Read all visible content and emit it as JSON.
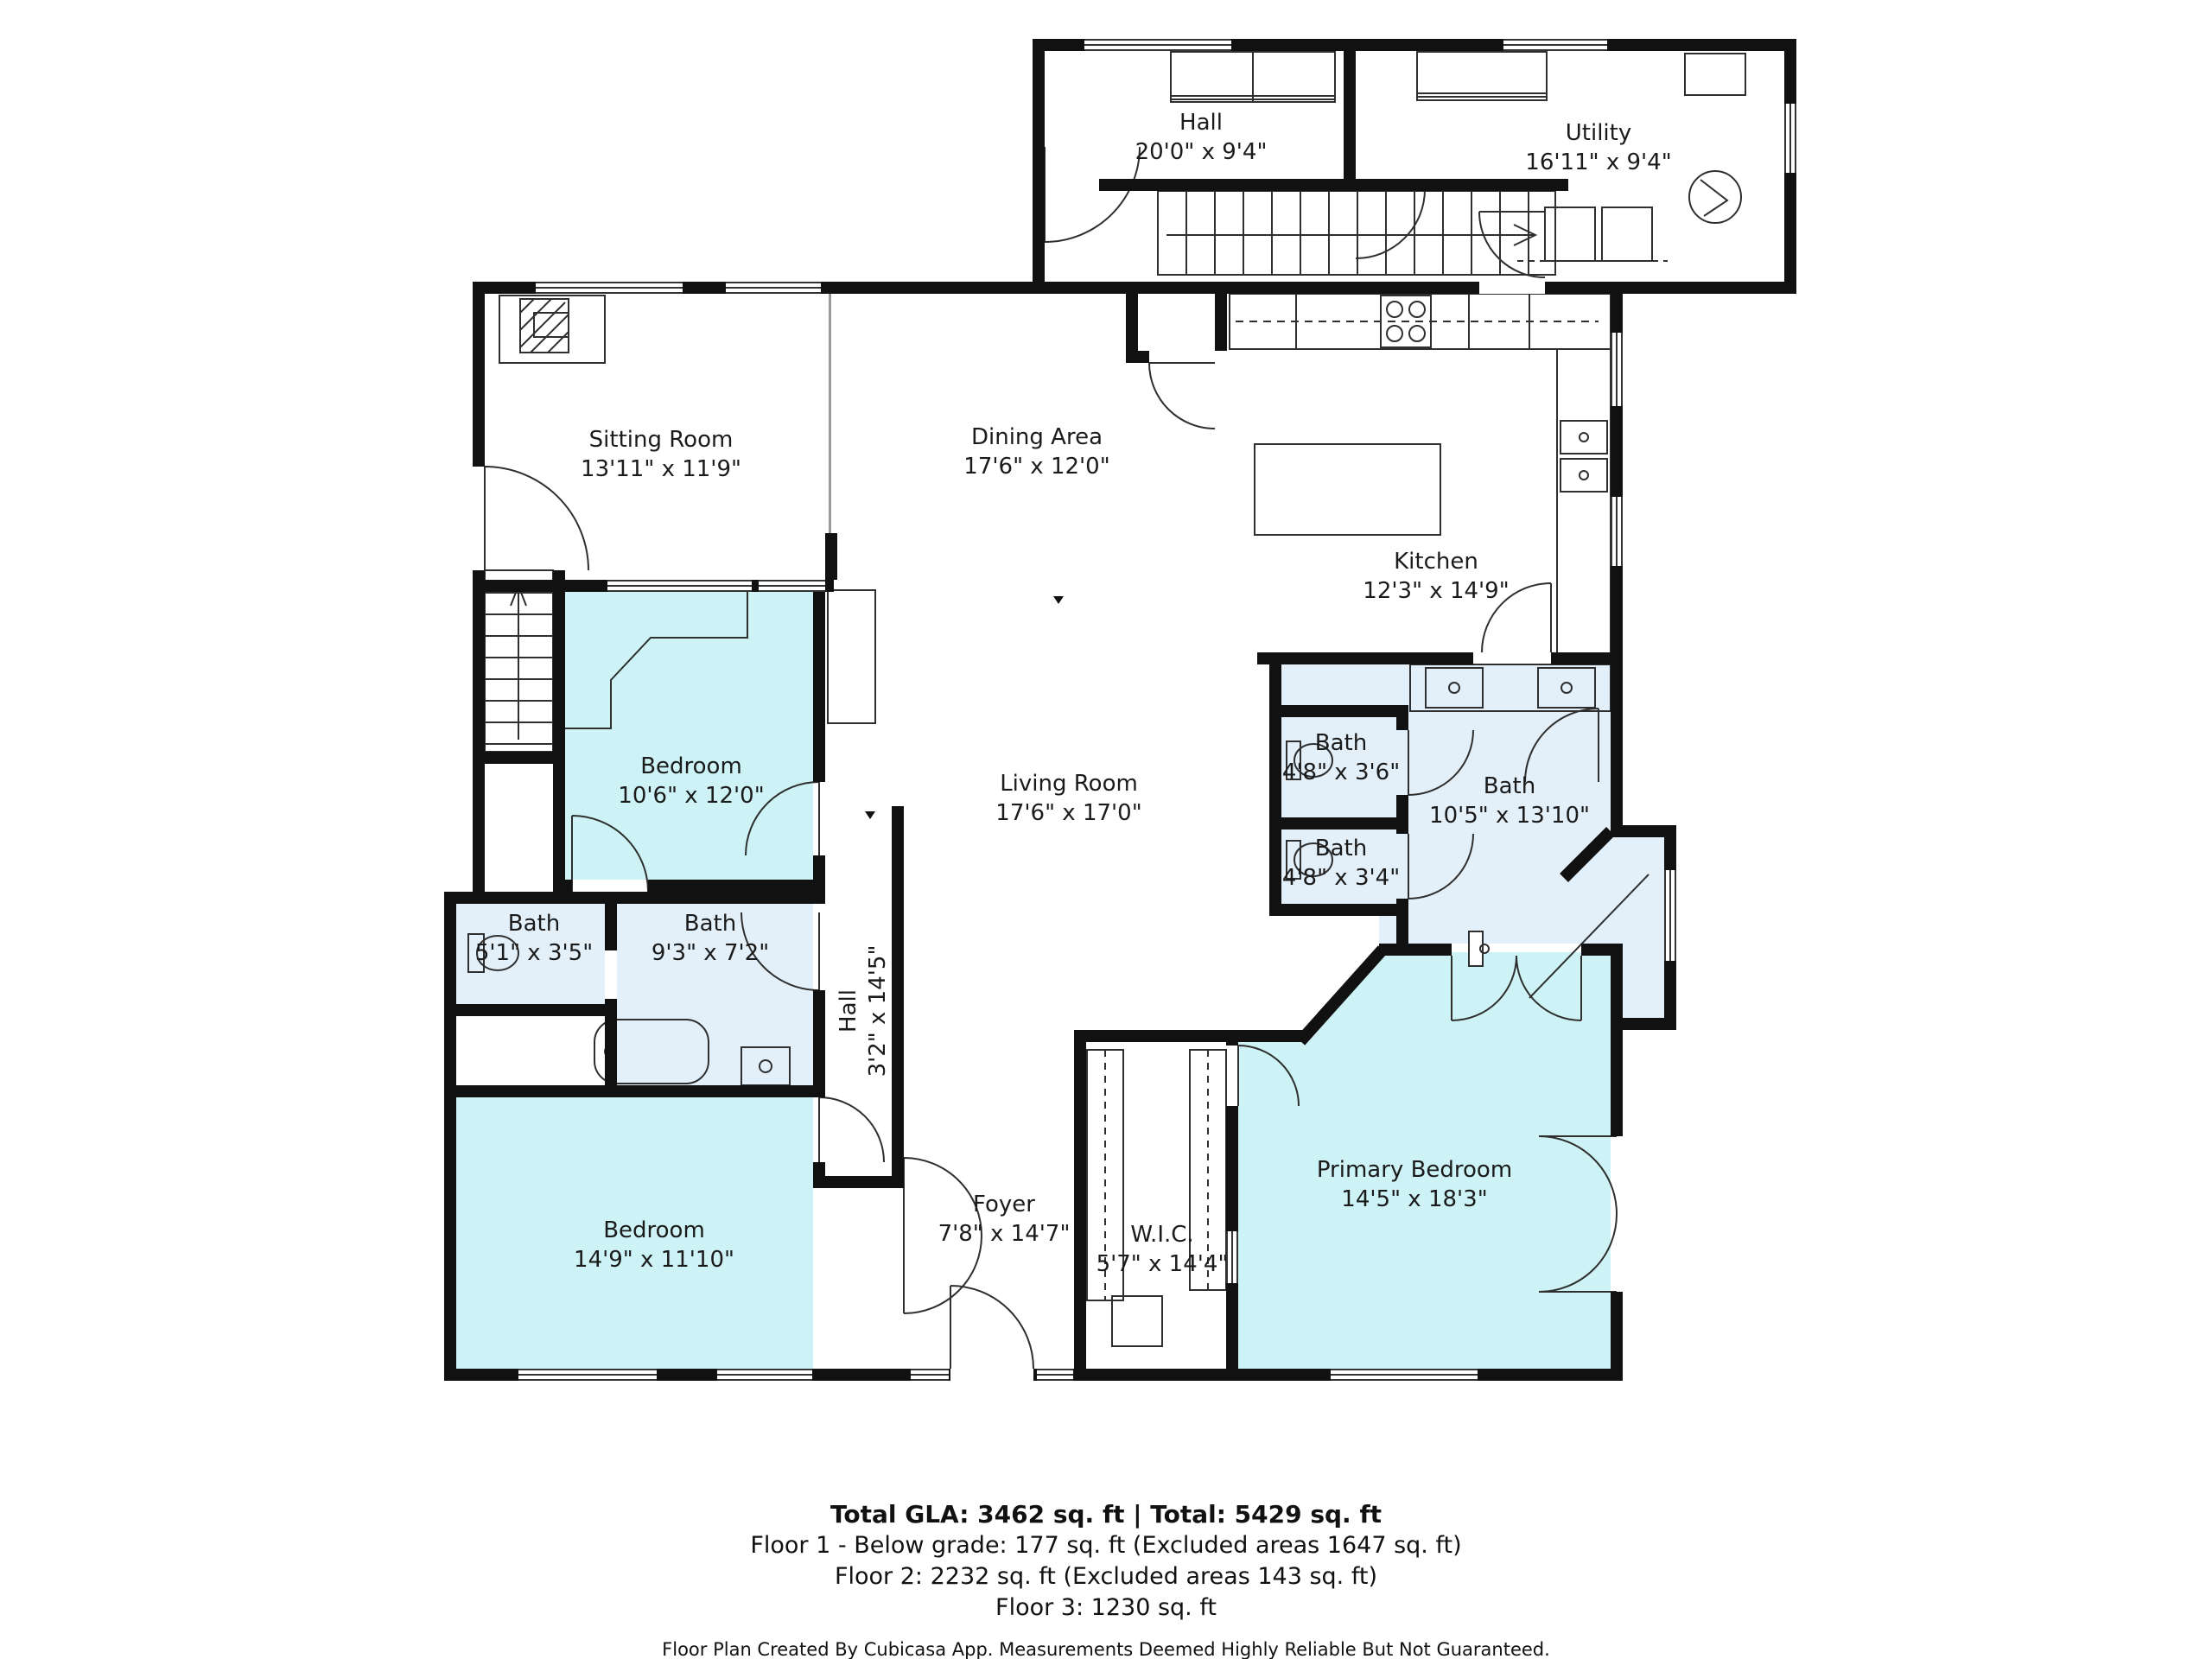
{
  "plan": {
    "rooms": {
      "hall_top": {
        "name": "Hall",
        "dims": "20'0\" x 9'4\""
      },
      "utility": {
        "name": "Utility",
        "dims": "16'11\" x 9'4\""
      },
      "sitting_room": {
        "name": "Sitting Room",
        "dims": "13'11\" x 11'9\""
      },
      "dining_area": {
        "name": "Dining Area",
        "dims": "17'6\" x 12'0\""
      },
      "kitchen": {
        "name": "Kitchen",
        "dims": "12'3\" x 14'9\""
      },
      "bedroom_upper": {
        "name": "Bedroom",
        "dims": "10'6\" x 12'0\""
      },
      "living_room": {
        "name": "Living Room",
        "dims": "17'6\" x 17'0\""
      },
      "bath_small_upper": {
        "name": "Bath",
        "dims": "4'8\" x 3'6\""
      },
      "bath_ensuite": {
        "name": "Bath",
        "dims": "10'5\" x 13'10\""
      },
      "bath_small_lower": {
        "name": "Bath",
        "dims": "4'8\" x 3'4\""
      },
      "bath_left_small": {
        "name": "Bath",
        "dims": "5'1\" x 3'5\""
      },
      "bath_left_large": {
        "name": "Bath",
        "dims": "9'3\" x 7'2\""
      },
      "hall_lower": {
        "name": "Hall",
        "dims": "3'2\" x 14'5\""
      },
      "foyer": {
        "name": "Foyer",
        "dims": "7'8\" x 14'7\""
      },
      "wic": {
        "name": "W.I.C.",
        "dims": "5'7\" x 14'4\""
      },
      "primary_bedroom": {
        "name": "Primary Bedroom",
        "dims": "14'5\" x 18'3\""
      },
      "bedroom_lower": {
        "name": "Bedroom",
        "dims": "14'9\" x 11'10\""
      }
    },
    "colors": {
      "room_highlight": "#cdf3f6",
      "bath_highlight": "#e3f0fa",
      "wall": "#111111"
    }
  },
  "footer": {
    "total_line": "Total GLA: 3462 sq. ft | Total: 5429 sq. ft",
    "floor1_line": "Floor 1 - Below grade: 177 sq. ft (Excluded areas 1647 sq. ft)",
    "floor2_line": "Floor 2: 2232 sq. ft (Excluded areas 143 sq. ft)",
    "floor3_line": "Floor 3: 1230 sq. ft",
    "credit_line": "Floor Plan Created By Cubicasa App. Measurements Deemed Highly Reliable But Not Guaranteed."
  }
}
